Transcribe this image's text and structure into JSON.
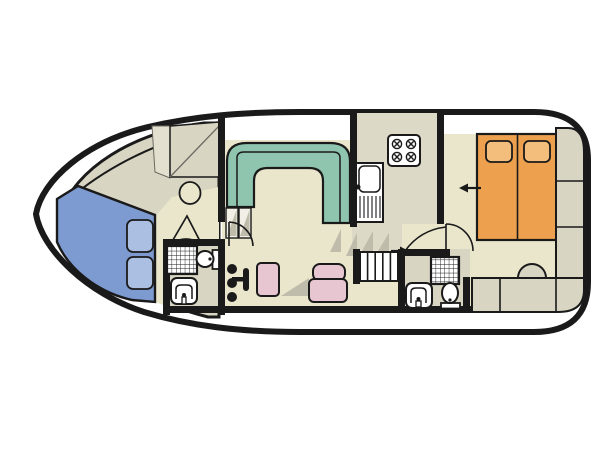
{
  "title": "Boat deck floor plan",
  "canvas": {
    "width": 600,
    "height": 450,
    "background": "#ffffff"
  },
  "colors": {
    "outline": "#1a1a1a",
    "hull_fill": "#ffffff",
    "deck": "#d8d5c3",
    "deck_light": "#e3e0d0",
    "floor": "#eae6cc",
    "galley_floor": "#dcd9c7",
    "settee_teal": "#8fc5af",
    "berth_blue": "#7e9bd1",
    "pillow_blue": "#aabfe2",
    "bed_orange": "#eda04e",
    "pillow_orange": "#f3bd7c",
    "seat_pink": "#e7c6d1",
    "fixture_white": "#ffffff",
    "shadow": "#bfbcab"
  },
  "plan": {
    "vessel": "motor-cruiser single-deck layout, bow left / stern right",
    "areas": {
      "bow_cabin": {
        "name": "forward cabin",
        "fixtures": [
          "v-berth double bed",
          "two pillows",
          "dresser",
          "stool",
          "entry door"
        ]
      },
      "forward_bathroom": {
        "name": "forward bathroom",
        "fixtures": [
          "shower",
          "toilet",
          "washbasin"
        ]
      },
      "salon": {
        "name": "salon",
        "fixtures": [
          "u-shaped settee",
          "steps down",
          "door arc"
        ]
      },
      "helm": {
        "name": "helm station",
        "fixtures": [
          "three instrument knobs",
          "steering wheel",
          "helm seat",
          "co-pilot seat"
        ]
      },
      "galley": {
        "name": "galley",
        "fixtures": [
          "four-burner stove",
          "sink with drainer"
        ]
      },
      "companionway": {
        "name": "companionway",
        "fixtures": [
          "stair treads",
          "step wedges",
          "direction arrow right"
        ]
      },
      "aft_bathroom": {
        "name": "aft bathroom",
        "fixtures": [
          "shower",
          "washbasin",
          "toilet"
        ]
      },
      "aft_cabin": {
        "name": "aft cabin",
        "fixtures": [
          "double bed",
          "two pillows",
          "direction arrow left",
          "half-round stool",
          "stern bench",
          "side lockers"
        ]
      }
    }
  }
}
